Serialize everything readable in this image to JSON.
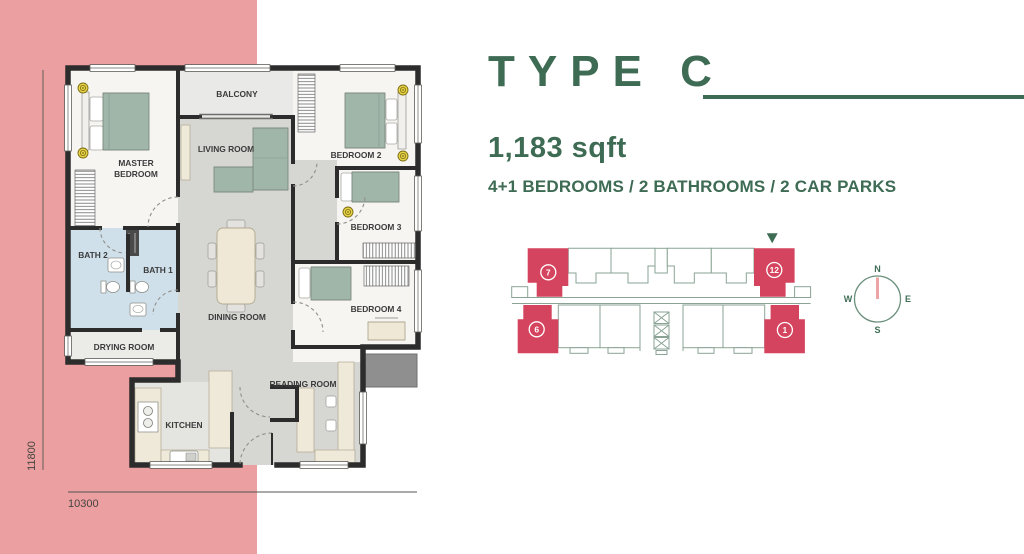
{
  "colors": {
    "pink": "#ec9fa0",
    "green": "#3e6b53",
    "red": "#d5445f",
    "keyplan_outline": "#8aa395"
  },
  "unit_details": {
    "title": "TYPE C",
    "area": "1,183 sqft",
    "specs": "4+1 BEDROOMS / 2 BATHROOMS / 2 CAR PARKS"
  },
  "floorplan": {
    "labels": {
      "master_line1": "MASTER",
      "master_line2": "BEDROOM",
      "balcony": "BALCONY",
      "living": "LIVING ROOM",
      "bedroom2": "BEDROOM 2",
      "bedroom3": "BEDROOM 3",
      "bedroom4": "BEDROOM 4",
      "bath1": "BATH 1",
      "bath2": "BATH 2",
      "dining": "DINING ROOM",
      "drying": "DRYING ROOM",
      "reading": "READING ROOM",
      "kitchen": "KITCHEN"
    },
    "dimensions": {
      "height": "11800",
      "width": "10300"
    }
  },
  "keyplan": {
    "unit_top_left": "7",
    "unit_top_right": "12",
    "unit_bottom_left": "6",
    "unit_bottom_right": "1"
  },
  "compass": {
    "n": "N",
    "e": "E",
    "s": "S",
    "w": "W"
  }
}
